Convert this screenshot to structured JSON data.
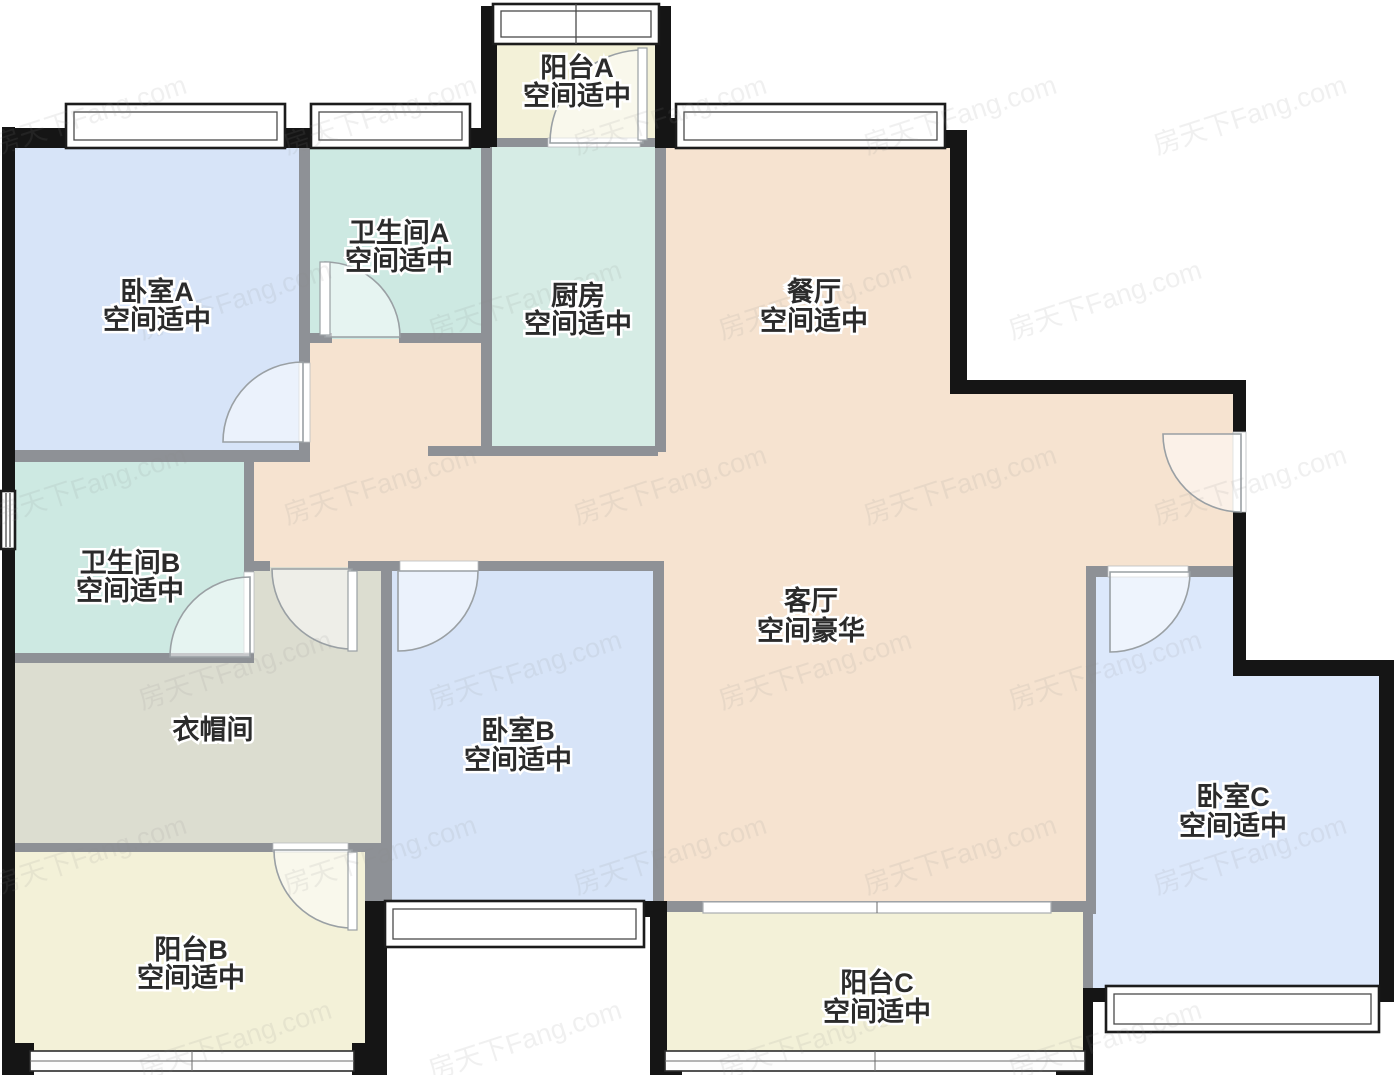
{
  "page": {
    "kind": "floor-plan"
  },
  "watermark": {
    "text": "房天下Fang.com"
  },
  "colors": {
    "bedroom": "#d7e4f8",
    "bedroom_c": "#dce8fb",
    "bathroom": "#cde9e2",
    "kitchen": "#d6ece5",
    "hall": "#f6e3d0",
    "balcony": "#f3f1d8",
    "cloakroom": "#dcddd0",
    "wall_exterior": "#151515",
    "wall_interior": "#8e9196",
    "label_text": "#2b2b2b"
  },
  "rooms": [
    {
      "id": "balcony-a",
      "name": "阳台A",
      "status": "空间适中"
    },
    {
      "id": "bedroom-a",
      "name": "卧室A",
      "status": "空间适中"
    },
    {
      "id": "bathroom-a",
      "name": "卫生间A",
      "status": "空间适中"
    },
    {
      "id": "kitchen",
      "name": "厨房",
      "status": "空间适中"
    },
    {
      "id": "dining",
      "name": "餐厅",
      "status": "空间适中"
    },
    {
      "id": "bathroom-b",
      "name": "卫生间B",
      "status": "空间适中"
    },
    {
      "id": "cloakroom",
      "name": "衣帽间",
      "status": ""
    },
    {
      "id": "bedroom-b",
      "name": "卧室B",
      "status": "空间适中"
    },
    {
      "id": "living",
      "name": "客厅",
      "status": "空间豪华"
    },
    {
      "id": "balcony-b",
      "name": "阳台B",
      "status": "空间适中"
    },
    {
      "id": "balcony-c",
      "name": "阳台C",
      "status": "空间适中"
    },
    {
      "id": "bedroom-c",
      "name": "卧室C",
      "status": "空间适中"
    }
  ]
}
